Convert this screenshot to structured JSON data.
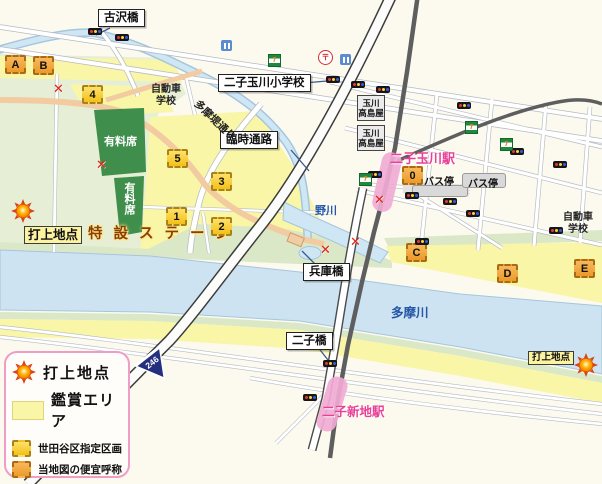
{
  "labels": {
    "furusawa_bridge": "古沢橋",
    "elementary_school": "二子玉川小学校",
    "temporary_passage": "臨時通路",
    "tamazutsumi_street": "多摩堤通り",
    "hyogo_bridge": "兵庫橋",
    "futako_bridge": "二子橋",
    "nogawa": "野川",
    "tamagawa": "多摩川",
    "station_futakotamagawa": "二子玉川駅",
    "station_futakoshinchi": "二子新地駅",
    "takashimaya_l1": "玉川",
    "takashimaya_l2": "高島屋",
    "driving_school_l1": "自動車",
    "driving_school_l2": "学校",
    "bus_stop_west": "バス停",
    "bus_stop_east": "バス停",
    "paid_seats_upper": "有料席",
    "paid_seats_lower": "有料席",
    "special_stage": "特設ステージ",
    "launch_site_west": "打上地点",
    "launch_site_east": "打上地点",
    "route_number": "246"
  },
  "zones": {
    "numbered": [
      "0",
      "1",
      "2",
      "3",
      "4",
      "5"
    ],
    "lettered": [
      "A",
      "B",
      "C",
      "D",
      "E"
    ]
  },
  "legend": {
    "items": [
      {
        "symbol": "sun-icon",
        "label": "打上地点"
      },
      {
        "symbol": "yellow-area-swatch",
        "label": "鑑賞エリア"
      },
      {
        "symbol": "gold-dashed-box",
        "label": "世田谷区指定区画"
      },
      {
        "symbol": "orange-dashed-box",
        "label": "当地図の便宜呼称"
      },
      {
        "symbol": "no-entry-cross",
        "label": "進入禁止"
      }
    ]
  },
  "colors": {
    "viewing_area": "#f9f6a8",
    "designated_box_gold": "#f2c118",
    "name_box_orange": "#ec9a28",
    "water": "#cde3f1",
    "park_green": "#e6efd6",
    "paid_seats_green": "#3f8e4b",
    "station_pink": "#f1aad4",
    "station_text_magenta": "#ea3f98",
    "river_text_blue": "#2457a8",
    "no_entry_red": "#e02010",
    "legend_border_pink": "#ef9cc6"
  }
}
